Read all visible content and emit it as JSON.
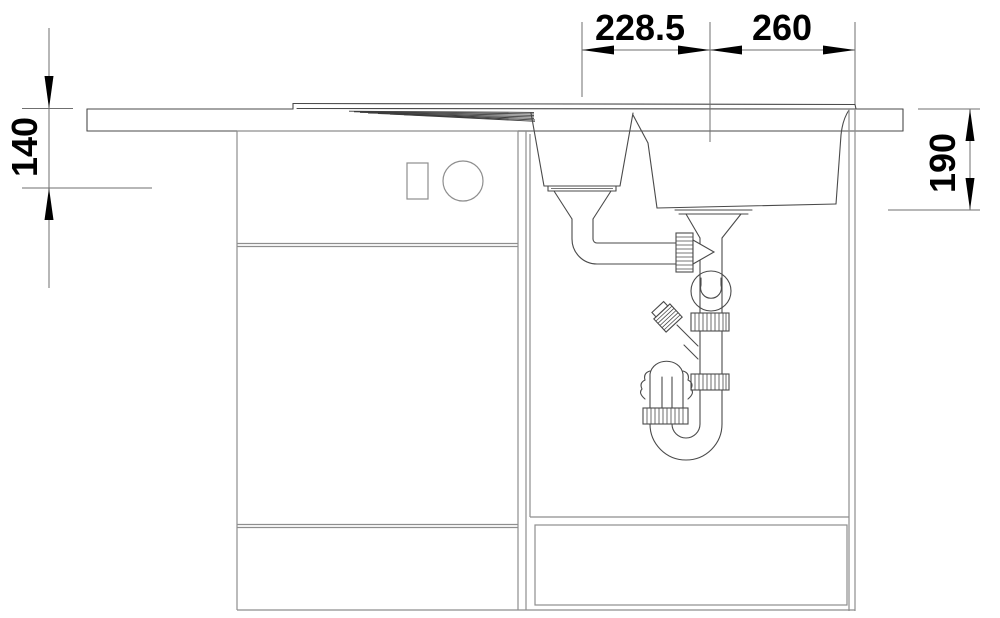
{
  "drawing": {
    "kind": "sink-cabinet-cross-section",
    "dimensions": {
      "top_left": "228.5",
      "top_right": "260",
      "left_side": "140",
      "right_side": "190"
    },
    "colors": {
      "background": "#ffffff",
      "sink_line": "#4a4a4a",
      "cabinet_line": "#8e8e8e",
      "dimension_line": "#6f6f6f",
      "text": "#000000"
    }
  }
}
